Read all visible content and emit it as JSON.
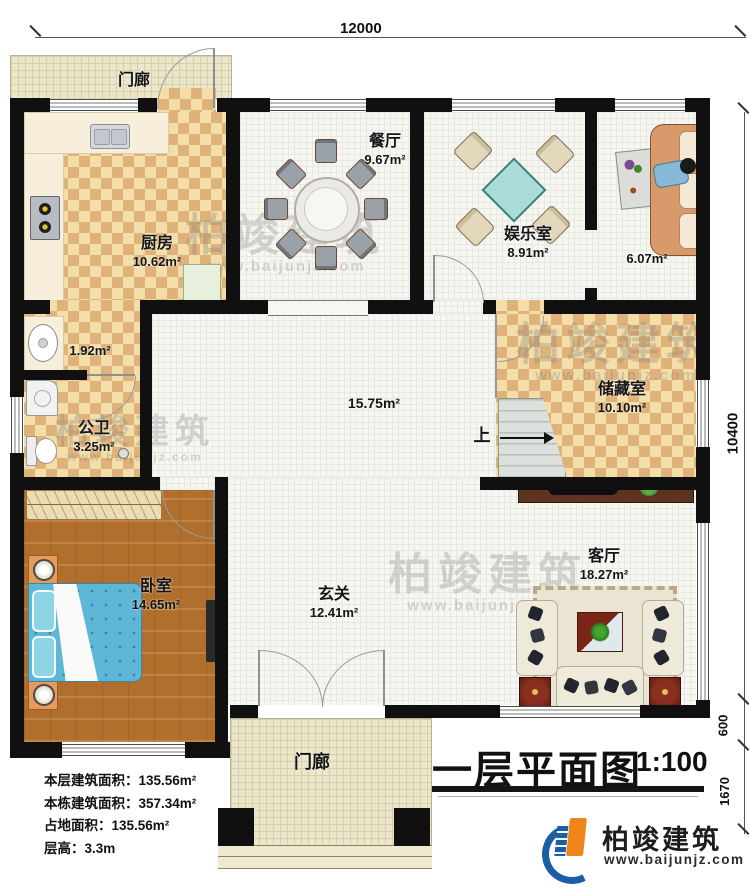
{
  "meta": {
    "title": "一层平面图",
    "scale": "1:100"
  },
  "dimensions": {
    "top_width": "12000",
    "right_height": "10400",
    "right_step": "600",
    "right_porch": "1670"
  },
  "rooms": {
    "porch_top": {
      "name": "门廊"
    },
    "kitchen": {
      "name": "厨房",
      "area": "10.62m²"
    },
    "dining": {
      "name": "餐厅",
      "area": "9.67m²"
    },
    "game": {
      "name": "娱乐室",
      "area": "8.91m²"
    },
    "lounge": {
      "area": "6.07m²"
    },
    "vanity": {
      "area": "1.92m²"
    },
    "bath": {
      "name": "公卫",
      "area": "3.25m²"
    },
    "hall": {
      "area": "15.75m²"
    },
    "storage": {
      "name": "储藏室",
      "area": "10.10m²"
    },
    "bedroom": {
      "name": "卧室",
      "area": "14.65m²"
    },
    "foyer": {
      "name": "玄关",
      "area": "12.41m²"
    },
    "living": {
      "name": "客厅",
      "area": "18.27m²"
    },
    "porch_bottom": {
      "name": "门廊"
    },
    "stairs": {
      "label": "上"
    }
  },
  "stats": {
    "floor_area": "本层建筑面积：135.56m²",
    "total_area": "本栋建筑面积：357.34m²",
    "footprint": "占地面积：135.56m²",
    "storey_height": "层高：3.3m"
  },
  "brand": {
    "name": "柏竣建筑",
    "url": "www.baijunjz.com"
  },
  "watermark": {
    "text": "柏竣建筑",
    "url": "www.baijunjz.com"
  },
  "colors": {
    "wall": "#101010",
    "checker_dark": "#dfb279",
    "checker_light": "#f3dda9",
    "wood": "#b06f2c",
    "bed_blue": "#5fb7d7",
    "game_table_teal": "#abdcd8",
    "brand_blue": "#1b5ea6",
    "brand_orange": "#f08519"
  }
}
